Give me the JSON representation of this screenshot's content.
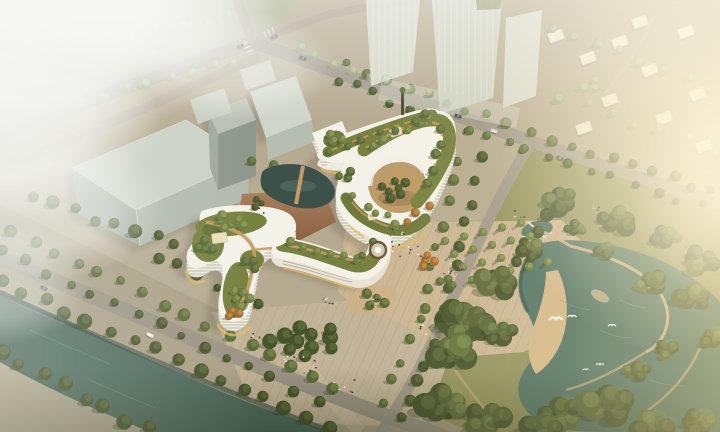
{
  "scene": {
    "title": "Aerial architectural rendering",
    "description": "Bird's-eye view of an organic white hospital-like complex with striped ribbon facades and terraced green roofs forming two courtyard loops, set between a tree-lined canal promenade, paved plazas with a fountain and tree bosque, a riverside park with a meandering lake, hazy massing buildings and sunlit towers.",
    "elements": [
      "hero-building",
      "green-roofs",
      "courtyards",
      "pond",
      "terrace",
      "fountain",
      "tree-bosque",
      "east-plaza",
      "south-plaza",
      "canal",
      "promenade-road",
      "intersection",
      "gray-massing-buildings",
      "glass-towers",
      "low-rise-district",
      "park-lake",
      "sand-beach",
      "birds",
      "fog",
      "sun-glow"
    ]
  },
  "colors": {
    "ground": "#b6ab91",
    "ground_nw": "#a9ad8e",
    "park_ground": "#93935f",
    "promenade": "#aba086",
    "plaza_east": "#cbb795",
    "plaza_south": "#c3b49a",
    "road": "#a19a8a",
    "river": "#4e6a5c",
    "river_dark": "#33483e",
    "river_light": "#74907e",
    "park_water": "#507365",
    "sand": "#d3b78a",
    "facade": "#f4f2e8",
    "facade_side": "#eceadd",
    "stripe": "#8f8a76",
    "glow": "#e7bd5a",
    "roof_green": "#76813f",
    "roof_green_dark": "#5f6b33",
    "roof_path": "#c49c61",
    "terrace": "#99704e",
    "courtyard": "#bd9a66",
    "pond": "#3d514b",
    "gray_top": "#cbd1c5",
    "gray_mid": "#b3baae",
    "gray_dark": "#99a296",
    "tower": "#d9e0d5",
    "house": "#ebe7d7",
    "trees": {
      "d": [
        "#46542c",
        "#5c6b38"
      ],
      "m": [
        "#5b6a38",
        "#74834a"
      ],
      "g": [
        "#6f7e44",
        "#8d9c55"
      ],
      "l": [
        "#9fab82",
        "#c3cda6"
      ],
      "o": [
        "#a06a2c",
        "#c48b42"
      ]
    },
    "tree_hi": "#9aa65d",
    "tree_shadow": "#2c3317",
    "people": [
      "#30302e",
      "#6e5f4c",
      "#f1efe8"
    ],
    "bird": "#fdfdf6",
    "fog": "#f4f5f1",
    "sun": "#ffe9b4"
  },
  "paint": {
    "tree_rows": [
      {
        "x1": 350,
        "y1": 66,
        "x2": 505,
        "y2": 122,
        "n": 9,
        "r": 5,
        "v": "m"
      },
      {
        "x1": 336,
        "y1": 80,
        "x2": 465,
        "y2": 128,
        "n": 8,
        "r": 4.5,
        "v": "d"
      },
      {
        "x1": 532,
        "y1": 132,
        "x2": 714,
        "y2": 192,
        "n": 10,
        "r": 5,
        "v": "m"
      },
      {
        "x1": 524,
        "y1": 148,
        "x2": 700,
        "y2": 206,
        "n": 9,
        "r": 4.5,
        "v": "d"
      },
      {
        "x1": 458,
        "y1": 162,
        "x2": 422,
        "y2": 308,
        "n": 8,
        "r": 5,
        "v": "m"
      },
      {
        "x1": 480,
        "y1": 158,
        "x2": 444,
        "y2": 312,
        "n": 8,
        "r": 5,
        "v": "d"
      },
      {
        "x1": 418,
        "y1": 320,
        "x2": 386,
        "y2": 402,
        "n": 5,
        "r": 5,
        "v": "m"
      },
      {
        "x1": 440,
        "y1": 326,
        "x2": 402,
        "y2": 420,
        "n": 6,
        "r": 5.5,
        "v": "d"
      },
      {
        "x1": 12,
        "y1": 230,
        "x2": 336,
        "y2": 386,
        "n": 16,
        "r": 5.5,
        "v": "m"
      },
      {
        "x1": 0,
        "y1": 252,
        "x2": 318,
        "y2": 400,
        "n": 15,
        "r": 5,
        "v": "d"
      },
      {
        "x1": 0,
        "y1": 282,
        "x2": 330,
        "y2": 428,
        "n": 16,
        "r": 6.5,
        "v": "d"
      },
      {
        "x1": 0,
        "y1": 352,
        "x2": 148,
        "y2": 430,
        "n": 8,
        "r": 7,
        "v": "d"
      },
      {
        "x1": 34,
        "y1": 198,
        "x2": 196,
        "y2": 252,
        "n": 9,
        "r": 6,
        "v": "d"
      },
      {
        "x1": 160,
        "y1": 256,
        "x2": 256,
        "y2": 306,
        "n": 6,
        "r": 5,
        "v": "d"
      },
      {
        "x1": 20,
        "y1": 118,
        "x2": 232,
        "y2": 60,
        "n": 11,
        "r": 5,
        "v": "l"
      },
      {
        "x1": 16,
        "y1": 58,
        "x2": 228,
        "y2": 16,
        "n": 10,
        "r": 6,
        "v": "l"
      },
      {
        "x1": 298,
        "y1": 50,
        "x2": 425,
        "y2": 94,
        "n": 8,
        "r": 4.5,
        "v": "l"
      },
      {
        "x1": 470,
        "y1": 128,
        "x2": 526,
        "y2": 150,
        "n": 4,
        "r": 4.5,
        "v": "m"
      },
      {
        "x1": 545,
        "y1": 212,
        "x2": 518,
        "y2": 262,
        "n": 4,
        "r": 6,
        "v": "d"
      },
      {
        "x1": 250,
        "y1": 160,
        "x2": 298,
        "y2": 176,
        "n": 3,
        "r": 5,
        "v": "m"
      },
      {
        "x1": 552,
        "y1": 26,
        "x2": 708,
        "y2": 88,
        "n": 8,
        "r": 5.5,
        "v": "l",
        "L": "ne"
      },
      {
        "x1": 560,
        "y1": 96,
        "x2": 712,
        "y2": 150,
        "n": 7,
        "r": 5.5,
        "v": "l",
        "L": "ne"
      },
      {
        "x1": 371,
        "y1": 146,
        "x2": 430,
        "y2": 118,
        "n": 6,
        "r": 4.5,
        "v": "g",
        "L": "roof"
      },
      {
        "x1": 440,
        "y1": 128,
        "x2": 430,
        "y2": 182,
        "n": 5,
        "r": 4.5,
        "v": "m",
        "L": "roof"
      },
      {
        "x1": 356,
        "y1": 198,
        "x2": 398,
        "y2": 222,
        "n": 5,
        "r": 4,
        "v": "g",
        "L": "roof"
      },
      {
        "x1": 404,
        "y1": 222,
        "x2": 430,
        "y2": 204,
        "n": 3,
        "r": 4,
        "v": "o",
        "L": "roof"
      },
      {
        "x1": 332,
        "y1": 152,
        "x2": 428,
        "y2": 116,
        "n": 7,
        "r": 4,
        "v": "m",
        "L": "roof"
      },
      {
        "x1": 292,
        "y1": 243,
        "x2": 356,
        "y2": 257,
        "n": 6,
        "r": 4.5,
        "v": "g",
        "L": "roof"
      },
      {
        "x1": 362,
        "y1": 256,
        "x2": 372,
        "y2": 242,
        "n": 2,
        "r": 4,
        "v": "m",
        "L": "roof"
      }
    ],
    "tree_clusters": [
      {
        "x": 394,
        "y": 188,
        "rx": 15,
        "ry": 11,
        "n": 7,
        "r": 4.5,
        "v": "d",
        "L": "roof"
      },
      {
        "x": 228,
        "y": 222,
        "rx": 17,
        "ry": 8,
        "n": 6,
        "r": 4.5,
        "v": "g",
        "L": "roof"
      },
      {
        "x": 206,
        "y": 246,
        "rx": 9,
        "ry": 9,
        "n": 4,
        "r": 4,
        "v": "m",
        "L": "roof"
      },
      {
        "x": 240,
        "y": 298,
        "rx": 10,
        "ry": 12,
        "n": 5,
        "r": 4.5,
        "v": "g",
        "L": "roof"
      },
      {
        "x": 234,
        "y": 313,
        "rx": 7,
        "ry": 6,
        "n": 3,
        "r": 4,
        "v": "o",
        "L": "roof"
      },
      {
        "x": 252,
        "y": 264,
        "rx": 8,
        "ry": 7,
        "n": 3,
        "r": 4,
        "v": "m",
        "L": "roof"
      },
      {
        "x": 258,
        "y": 204,
        "rx": 8,
        "ry": 5,
        "n": 3,
        "r": 3.5,
        "v": "d",
        "L": "roof"
      },
      {
        "x": 345,
        "y": 176,
        "rx": 8,
        "ry": 7,
        "n": 3,
        "r": 4,
        "v": "m",
        "L": "roof"
      },
      {
        "x": 334,
        "y": 138,
        "rx": 9,
        "ry": 6,
        "n": 3,
        "r": 4,
        "v": "g",
        "L": "roof"
      },
      {
        "x": 305,
        "y": 340,
        "rx": 40,
        "ry": 16,
        "n": 11,
        "r": 7,
        "v": "d"
      },
      {
        "x": 428,
        "y": 262,
        "rx": 10,
        "ry": 7,
        "n": 4,
        "r": 4,
        "v": "o"
      },
      {
        "x": 448,
        "y": 282,
        "rx": 9,
        "ry": 6,
        "n": 3,
        "r": 4,
        "v": "m"
      },
      {
        "x": 372,
        "y": 300,
        "rx": 14,
        "ry": 9,
        "n": 4,
        "r": 4.5,
        "v": "m"
      },
      {
        "x": 590,
        "y": 86,
        "rx": 10,
        "ry": 7,
        "n": 3,
        "r": 5,
        "v": "l",
        "L": "ne"
      }
    ],
    "park_masses": [
      [
        462,
        322,
        34
      ],
      [
        498,
        282,
        26
      ],
      [
        452,
        354,
        28
      ],
      [
        444,
        404,
        30
      ],
      [
        486,
        418,
        28
      ],
      [
        560,
        200,
        22
      ],
      [
        618,
        220,
        24
      ],
      [
        666,
        236,
        20
      ],
      [
        700,
        260,
        24
      ],
      [
        500,
        332,
        22
      ],
      [
        530,
        250,
        18
      ],
      [
        560,
        414,
        28
      ],
      [
        606,
        406,
        32
      ],
      [
        652,
        426,
        24
      ],
      [
        698,
        424,
        24
      ],
      [
        540,
        430,
        26
      ],
      [
        650,
        284,
        20
      ],
      [
        694,
        298,
        22
      ],
      [
        714,
        338,
        18
      ],
      [
        666,
        350,
        16
      ],
      [
        636,
        372,
        18
      ],
      [
        604,
        250,
        14
      ],
      [
        576,
        228,
        14
      ]
    ],
    "bosque": {
      "x0": 445,
      "y0": 241,
      "ci": [
        19,
        -4.5
      ],
      "rj": [
        9,
        13
      ],
      "cols": 5,
      "rows": 4,
      "r": 4.3
    },
    "houses": [
      [
        556,
        36,
        -20
      ],
      [
        588,
        58,
        -20
      ],
      [
        620,
        42,
        -20
      ],
      [
        650,
        70,
        -20
      ],
      [
        686,
        32,
        -20
      ],
      [
        664,
        118,
        -20
      ],
      [
        698,
        94,
        -20
      ],
      [
        610,
        100,
        -20
      ],
      [
        584,
        128,
        -20
      ],
      [
        704,
        146,
        -20
      ],
      [
        640,
        22,
        -20
      ]
    ],
    "cars": [
      [
        150,
        335,
        27,
        "#f2f2ec"
      ],
      [
        44,
        288,
        27,
        "#4e4e52"
      ],
      [
        240,
        46,
        -20,
        "#45454c"
      ],
      [
        274,
        37,
        -24,
        "#6a6a70"
      ],
      [
        303,
        58,
        22,
        "#52525a"
      ],
      [
        458,
        116,
        20,
        "#47474e"
      ],
      [
        494,
        131,
        20,
        "#d8d8d0"
      ],
      [
        560,
        158,
        18,
        "#5e5e64"
      ]
    ],
    "birds": [
      [
        556,
        320,
        1.7
      ],
      [
        572,
        317,
        1.1
      ],
      [
        612,
        326,
        1.0
      ],
      [
        600,
        365,
        1.0
      ],
      [
        586,
        370,
        0.8
      ]
    ],
    "people": [
      [
        408,
        250,
        12,
        16
      ],
      [
        452,
        268,
        8,
        12
      ],
      [
        332,
        300,
        6,
        9
      ],
      [
        300,
        364,
        14,
        20
      ],
      [
        342,
        386,
        9,
        14
      ],
      [
        428,
        330,
        6,
        10
      ],
      [
        256,
        336,
        5,
        7
      ],
      [
        372,
        302,
        5,
        9
      ],
      [
        598,
        208,
        4,
        7
      ],
      [
        518,
        214,
        4,
        7
      ],
      [
        262,
        210,
        5,
        8
      ],
      [
        395,
        232,
        6,
        9
      ]
    ]
  }
}
